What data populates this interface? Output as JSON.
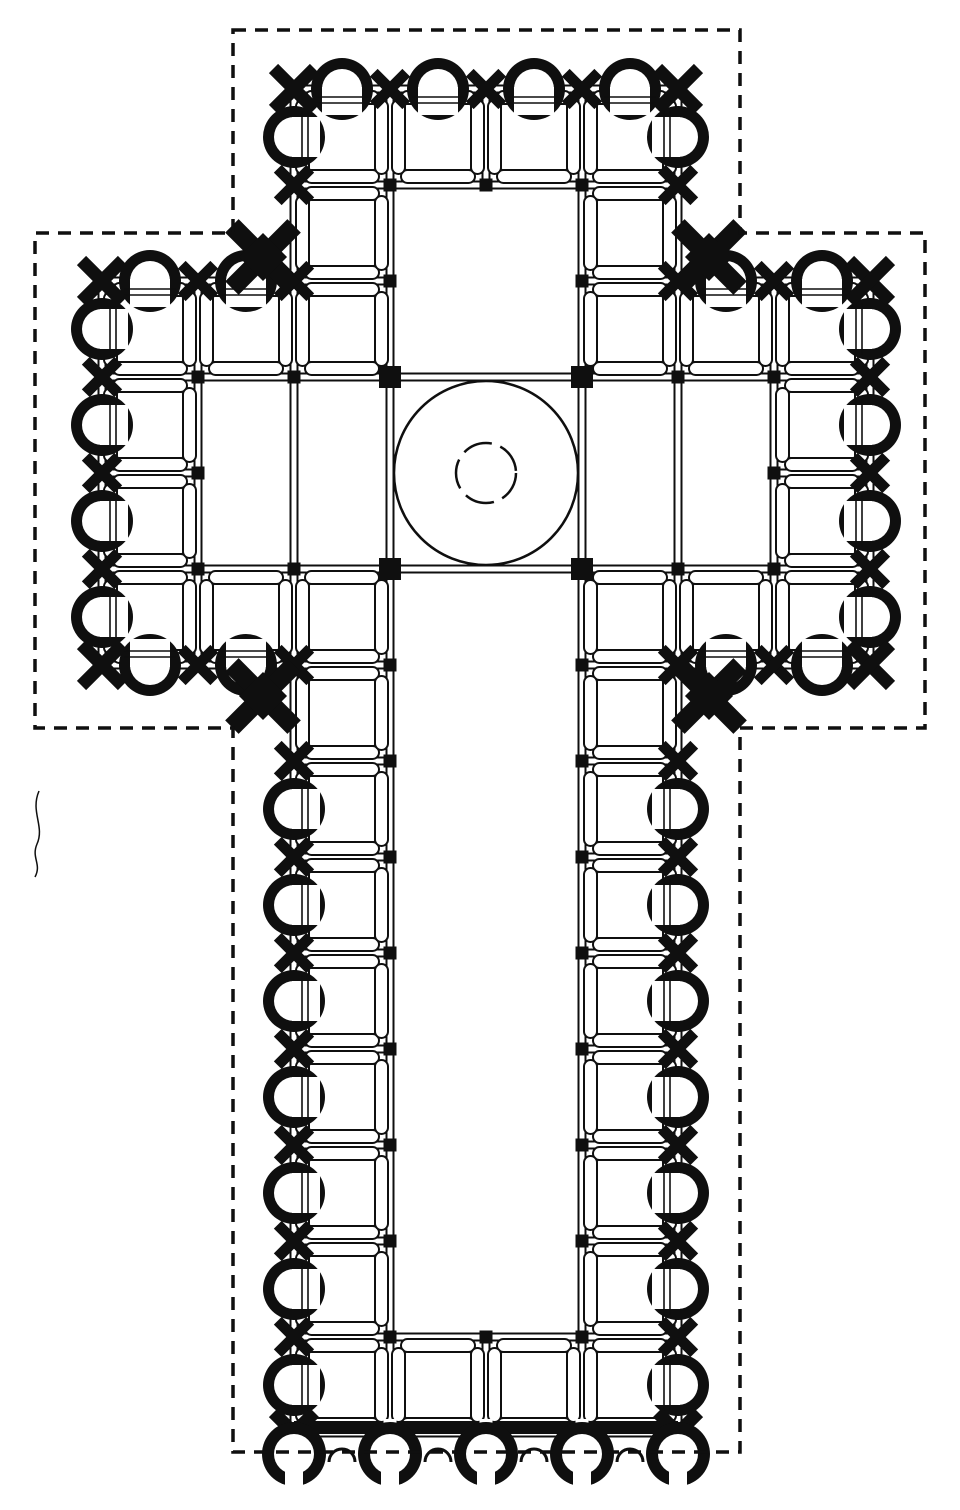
{
  "plan": {
    "canvas": {
      "w": 960,
      "h": 1510,
      "ink": "#0f0f0f",
      "paper": "#ffffff"
    },
    "grid": {
      "x0": 102,
      "y0": 89,
      "bay": 96
    },
    "outline_points": [
      [
        233,
        30
      ],
      [
        740,
        30
      ],
      [
        740,
        233
      ],
      [
        925,
        233
      ],
      [
        925,
        728
      ],
      [
        740,
        728
      ],
      [
        740,
        1452
      ],
      [
        233,
        1452
      ],
      [
        233,
        728
      ],
      [
        35,
        728
      ],
      [
        35,
        233
      ],
      [
        233,
        233
      ]
    ],
    "outline_dash": "13 9",
    "outline_width": 3.5,
    "wall_gap": 3.5,
    "wall_stroke": 2,
    "walls": {
      "v": [
        [
          102,
          281,
          665
        ],
        [
          198,
          281,
          665
        ],
        [
          294,
          89,
          1433
        ],
        [
          390,
          89,
          1433
        ],
        [
          486,
          89,
          185
        ],
        [
          486,
          1337,
          1433
        ],
        [
          582,
          89,
          1433
        ],
        [
          678,
          89,
          1433
        ],
        [
          774,
          281,
          665
        ],
        [
          870,
          281,
          665
        ]
      ],
      "h": [
        [
          89,
          294,
          678
        ],
        [
          185,
          294,
          678
        ],
        [
          281,
          102,
          390
        ],
        [
          281,
          582,
          870
        ],
        [
          377,
          102,
          870
        ],
        [
          473,
          102,
          198
        ],
        [
          473,
          774,
          870
        ],
        [
          569,
          102,
          870
        ],
        [
          665,
          102,
          390
        ],
        [
          665,
          582,
          870
        ],
        [
          761,
          294,
          390
        ],
        [
          761,
          582,
          678
        ],
        [
          857,
          294,
          390
        ],
        [
          857,
          582,
          678
        ],
        [
          953,
          294,
          390
        ],
        [
          953,
          582,
          678
        ],
        [
          1049,
          294,
          390
        ],
        [
          1049,
          582,
          678
        ],
        [
          1145,
          294,
          390
        ],
        [
          1145,
          582,
          678
        ],
        [
          1241,
          294,
          390
        ],
        [
          1241,
          582,
          678
        ],
        [
          1337,
          294,
          678
        ],
        [
          1433,
          294,
          678
        ]
      ]
    },
    "bay": {
      "circle_r": 46,
      "inset": 11,
      "arch_th": 13,
      "edge_pad": 2,
      "stroke": 2
    },
    "bays": [
      [
        2,
        0
      ],
      [
        3,
        0
      ],
      [
        4,
        0
      ],
      [
        5,
        0
      ],
      [
        2,
        1
      ],
      [
        5,
        1
      ],
      [
        0,
        2
      ],
      [
        1,
        2
      ],
      [
        2,
        2
      ],
      [
        5,
        2
      ],
      [
        6,
        2
      ],
      [
        7,
        2
      ],
      [
        0,
        3
      ],
      [
        7,
        3
      ],
      [
        0,
        4
      ],
      [
        7,
        4
      ],
      [
        0,
        5
      ],
      [
        1,
        5
      ],
      [
        2,
        5
      ],
      [
        5,
        5
      ],
      [
        6,
        5
      ],
      [
        7,
        5
      ],
      [
        2,
        6
      ],
      [
        5,
        6
      ],
      [
        2,
        7
      ],
      [
        5,
        7
      ],
      [
        2,
        8
      ],
      [
        5,
        8
      ],
      [
        2,
        9
      ],
      [
        5,
        9
      ],
      [
        2,
        10
      ],
      [
        5,
        10
      ],
      [
        2,
        11
      ],
      [
        5,
        11
      ],
      [
        2,
        12
      ],
      [
        5,
        12
      ],
      [
        2,
        13
      ],
      [
        3,
        13
      ],
      [
        4,
        13
      ],
      [
        5,
        13
      ]
    ],
    "niche": {
      "r_out": 31,
      "r_in": 20,
      "open_w": 40,
      "erase_d": 28,
      "line_off": [
        8,
        14
      ],
      "line_len": 52,
      "line_w": 1.6
    },
    "niches": [
      {
        "x": 342,
        "y": 89,
        "d": "n"
      },
      {
        "x": 438,
        "y": 89,
        "d": "n"
      },
      {
        "x": 534,
        "y": 89,
        "d": "n"
      },
      {
        "x": 630,
        "y": 89,
        "d": "n"
      },
      {
        "x": 150,
        "y": 281,
        "d": "n"
      },
      {
        "x": 246,
        "y": 281,
        "d": "n"
      },
      {
        "x": 726,
        "y": 281,
        "d": "n"
      },
      {
        "x": 822,
        "y": 281,
        "d": "n"
      },
      {
        "x": 150,
        "y": 665,
        "d": "s"
      },
      {
        "x": 246,
        "y": 665,
        "d": "s"
      },
      {
        "x": 726,
        "y": 665,
        "d": "s"
      },
      {
        "x": 822,
        "y": 665,
        "d": "s"
      },
      {
        "x": 294,
        "y": 137,
        "d": "w"
      },
      {
        "x": 678,
        "y": 137,
        "d": "e"
      },
      {
        "x": 102,
        "y": 329,
        "d": "w"
      },
      {
        "x": 102,
        "y": 425,
        "d": "w"
      },
      {
        "x": 102,
        "y": 521,
        "d": "w"
      },
      {
        "x": 102,
        "y": 617,
        "d": "w"
      },
      {
        "x": 870,
        "y": 329,
        "d": "e"
      },
      {
        "x": 870,
        "y": 425,
        "d": "e"
      },
      {
        "x": 870,
        "y": 521,
        "d": "e"
      },
      {
        "x": 870,
        "y": 617,
        "d": "e"
      },
      {
        "x": 294,
        "y": 809,
        "d": "w"
      },
      {
        "x": 294,
        "y": 905,
        "d": "w"
      },
      {
        "x": 294,
        "y": 1001,
        "d": "w"
      },
      {
        "x": 294,
        "y": 1097,
        "d": "w"
      },
      {
        "x": 294,
        "y": 1193,
        "d": "w"
      },
      {
        "x": 294,
        "y": 1289,
        "d": "w"
      },
      {
        "x": 294,
        "y": 1385,
        "d": "w"
      },
      {
        "x": 678,
        "y": 809,
        "d": "e"
      },
      {
        "x": 678,
        "y": 905,
        "d": "e"
      },
      {
        "x": 678,
        "y": 1001,
        "d": "e"
      },
      {
        "x": 678,
        "y": 1097,
        "d": "e"
      },
      {
        "x": 678,
        "y": 1193,
        "d": "e"
      },
      {
        "x": 678,
        "y": 1289,
        "d": "e"
      },
      {
        "x": 678,
        "y": 1385,
        "d": "e"
      }
    ],
    "pier_size": 13,
    "wall_pier": {
      "len": 46,
      "w": 11
    },
    "wall_piers": [
      [
        390,
        89
      ],
      [
        486,
        89
      ],
      [
        582,
        89
      ],
      [
        294,
        185
      ],
      [
        678,
        185
      ],
      [
        198,
        281
      ],
      [
        774,
        281
      ],
      [
        294,
        281
      ],
      [
        678,
        281
      ],
      [
        102,
        377
      ],
      [
        102,
        473
      ],
      [
        102,
        569
      ],
      [
        870,
        377
      ],
      [
        870,
        473
      ],
      [
        870,
        569
      ],
      [
        198,
        665
      ],
      [
        774,
        665
      ],
      [
        294,
        665
      ],
      [
        678,
        665
      ],
      [
        294,
        761
      ],
      [
        294,
        857
      ],
      [
        294,
        953
      ],
      [
        294,
        1049
      ],
      [
        294,
        1145
      ],
      [
        294,
        1241
      ],
      [
        294,
        1337
      ],
      [
        678,
        761
      ],
      [
        678,
        857
      ],
      [
        678,
        953
      ],
      [
        678,
        1049
      ],
      [
        678,
        1145
      ],
      [
        678,
        1241
      ],
      [
        678,
        1337
      ]
    ],
    "corner_pier": {
      "len": 58,
      "w": 13
    },
    "corner_piers": [
      [
        294,
        89
      ],
      [
        678,
        89
      ],
      [
        102,
        281
      ],
      [
        870,
        281
      ],
      [
        102,
        665
      ],
      [
        870,
        665
      ],
      [
        294,
        1433
      ],
      [
        678,
        1433
      ]
    ],
    "reentrant": {
      "len": 88,
      "w": 19,
      "core": 34
    },
    "reentrant_masses": [
      [
        263,
        257
      ],
      [
        709,
        257
      ],
      [
        263,
        696
      ],
      [
        709,
        696
      ]
    ],
    "crossing": {
      "cx": 486,
      "cy": 473,
      "r_outer": 92,
      "r_inner": 30,
      "inner_dash": "30 9",
      "stroke": 2.5,
      "pier_size": 22,
      "piers": [
        [
          390,
          377
        ],
        [
          582,
          377
        ],
        [
          390,
          569
        ],
        [
          582,
          569
        ]
      ]
    },
    "facade": {
      "band": {
        "x1": 294,
        "x2": 678,
        "y": 1421,
        "h": 13,
        "gaps": [
          390,
          486,
          582
        ],
        "gap_w": 13
      },
      "big_arches": {
        "cx": [
          294,
          390,
          486,
          582,
          678
        ],
        "cy": 1454,
        "r_out": 32,
        "r_in": 20,
        "slot_w": 18,
        "slot_h": 26
      },
      "small_arches": {
        "cx": [
          342,
          438,
          534,
          630
        ],
        "cy": 1462,
        "r": 13,
        "stroke": 3
      }
    },
    "scan_mark": "M39 791 C 30 812, 45 826, 37 844 C 31 858, 42 864, 35 877"
  }
}
